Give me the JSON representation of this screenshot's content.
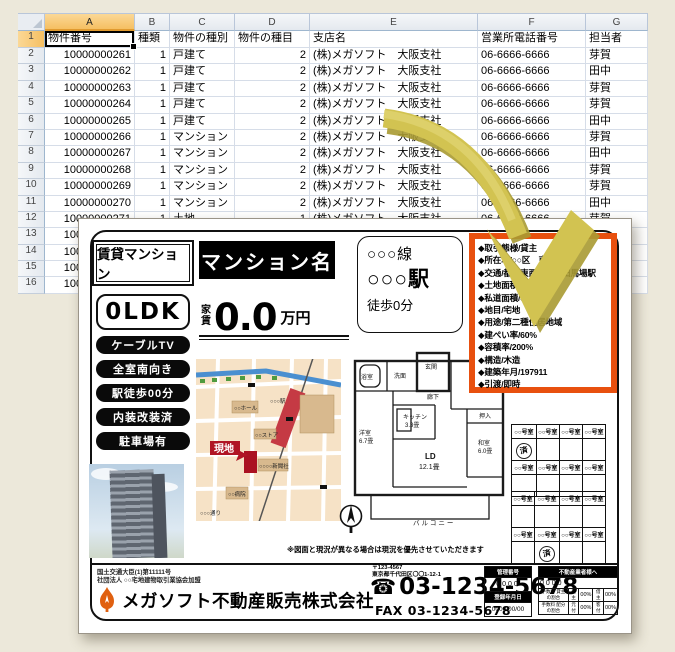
{
  "colors": {
    "accent_orange": "#e8500f",
    "arrow_yellow": "#d2c351",
    "selection_amber": "#f5bf62"
  },
  "spreadsheet": {
    "col_headers": [
      "A",
      "B",
      "C",
      "D",
      "E",
      "F",
      "G"
    ],
    "header_row": [
      "物件番号",
      "種類",
      "物件の種別",
      "物件の種目",
      "支店名",
      "営業所電話番号",
      "担当者"
    ],
    "rows": [
      [
        "10000000261",
        "1",
        "戸建て",
        "2",
        "(株)メガソフト　大阪支社",
        "06-6666-6666",
        "芽賀"
      ],
      [
        "10000000262",
        "1",
        "戸建て",
        "2",
        "(株)メガソフト　大阪支社",
        "06-6666-6666",
        "田中"
      ],
      [
        "10000000263",
        "1",
        "戸建て",
        "2",
        "(株)メガソフト　大阪支社",
        "06-6666-6666",
        "芽賀"
      ],
      [
        "10000000264",
        "1",
        "戸建て",
        "2",
        "(株)メガソフト　大阪支社",
        "06-6666-6666",
        "芽賀"
      ],
      [
        "10000000265",
        "1",
        "戸建て",
        "2",
        "(株)メガソフト　大阪支社",
        "06-6666-6666",
        "田中"
      ],
      [
        "10000000266",
        "1",
        "マンション",
        "2",
        "(株)メガソフト　大阪支社",
        "06-6666-6666",
        "芽賀"
      ],
      [
        "10000000267",
        "1",
        "マンション",
        "2",
        "(株)メガソフト　大阪支社",
        "06-6666-6666",
        "田中"
      ],
      [
        "10000000268",
        "1",
        "マンション",
        "2",
        "(株)メガソフト　大阪支社",
        "06-6666-6666",
        "芽賀"
      ],
      [
        "10000000269",
        "1",
        "マンション",
        "2",
        "(株)メガソフト　大阪支社",
        "06-6666-6666",
        "芽賀"
      ],
      [
        "10000000270",
        "1",
        "マンション",
        "2",
        "(株)メガソフト　大阪支社",
        "06-6666-6666",
        "田中"
      ],
      [
        "10000000271",
        "1",
        "土地",
        "1",
        "(株)メガソフト　大阪支社",
        "06-6666-6666",
        "芽賀"
      ],
      [
        "10000000272",
        "",
        "",
        "",
        "",
        "",
        ""
      ],
      [
        "10000000273",
        "",
        "",
        "",
        "",
        "",
        ""
      ],
      [
        "10000000274",
        "",
        "",
        "",
        "",
        "",
        ""
      ],
      [
        "10000000275",
        "",
        "",
        "",
        "",
        "",
        ""
      ]
    ]
  },
  "flyer": {
    "type_label": "賃貸マンション",
    "name_label": "マンション名",
    "ldk": "0LDK",
    "rent_label_1": "家",
    "rent_label_2": "賃",
    "rent_value": "0.0",
    "rent_unit": "万円",
    "access": {
      "line": "○○○線",
      "station": "○○○駅",
      "walk": "徒歩0分"
    },
    "badges": [
      "ケーブルTV",
      "全室南向き",
      "駅徒歩00分",
      "内装改装済",
      "駐車場有"
    ],
    "details": [
      "◆取引態様/貸主",
      "◆所在地/○○区　東金町",
      "◆交通/都営東西線　高田馬場駅",
      "◆土地面積/45.36㎡",
      "◆私道面積/6.12㎡",
      "◆地目/宅地",
      "◆用途/第二種住居地域",
      "◆建ぺい率/60%",
      "◆容積率/200%",
      "◆構造/木造",
      "◆建築年月/197911",
      "◆引渡/即時"
    ],
    "map": {
      "site": "現地",
      "labels": {
        "hall": "○○ホール",
        "station": "○○○駅",
        "store": "○○ストア",
        "news": "○○○○新聞社",
        "hospital": "○○病院",
        "street": "○○○通り"
      }
    },
    "floorplan": {
      "bath": "浴室",
      "wash": "洗面",
      "entrance": "玄関",
      "hall": "廊下",
      "west1": "洋室",
      "west1_size": "5.2畳",
      "closet": "押入",
      "washitsu": "和室",
      "washitsu_size": "6.0畳",
      "kitchen": "キッチン",
      "kitchen_size": "3.3畳",
      "ld": "LD",
      "ld_size": "12.1畳",
      "west2": "洋室",
      "west2_size": "6.7畳",
      "balcony": "バルコニー"
    },
    "room_grid": {
      "header": "○○号室",
      "stamp": "済",
      "stamps": [
        [
          0,
          0,
          0
        ],
        [
          1,
          1,
          1
        ]
      ]
    },
    "note": "※図面と現況が異なる場合は現況を優先させていただきます",
    "footer": {
      "license1": "国土交通大臣(1)第11111号",
      "license2": "社団法人 ○○宅地建物取引業協会加盟",
      "company": "メガソフト不動産販売株式会社",
      "postal": "〒123-4567",
      "address": "東京都千代田区〇〇1-12-1",
      "tel": "03-1234-5678",
      "fax": "FAX 03-1234-5678",
      "mini_left": {
        "h1": "管理番号",
        "v1": "0000",
        "h2": "登録年月日",
        "v2": "0000/00/00"
      },
      "mini_right": {
        "header": "不動産業者様へ",
        "code": "0000",
        "rows": [
          {
            "label": "手数料 貸主の割合",
            "c1": "貸主",
            "p1": "00%",
            "c2": "借主",
            "p2": "00%"
          },
          {
            "label": "手数料 配分の割合",
            "c1": "元付",
            "p1": "00%",
            "c2": "客付",
            "p2": "00%"
          }
        ]
      }
    }
  }
}
